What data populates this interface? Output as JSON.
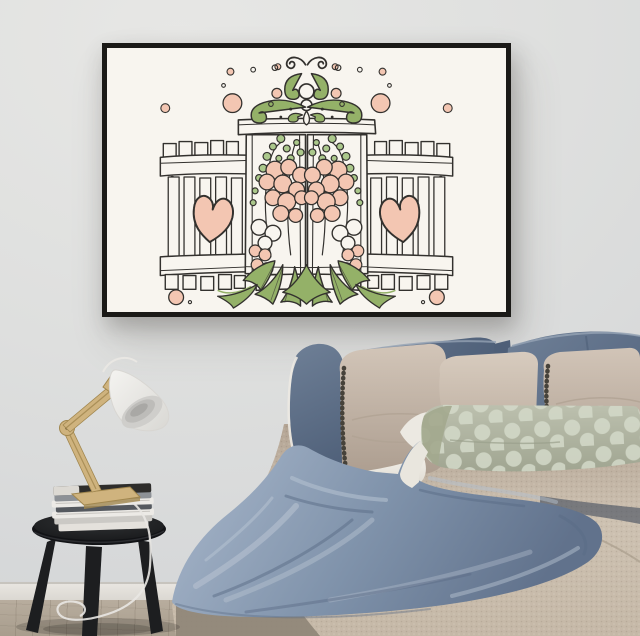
{
  "scene": {
    "setting": "bedroom interior photograph, no text visible",
    "objects": [
      {
        "name": "framed-wall-art",
        "description": "hand-drawn garden-gate illustration: green ornamental scrolls at top, white picket gate and shutters, two pink hearts, pink hollyhock flowers, green leaves, scattered pink dots on cream paper, thin black frame"
      },
      {
        "name": "bed",
        "description": "bed with blue linen pillows with white piping, taupe pillows with dark pompom trim, sage polka-dot lumbar pillow, beige woven bedspread, rumpled blue throw blanket"
      },
      {
        "name": "side-table",
        "description": "round black three-legged stool stacked with magazines"
      },
      {
        "name": "desk-lamp",
        "description": "wooden articulated task lamp with white shade and white cord"
      },
      {
        "name": "floor",
        "description": "light wood floor with white baseboard"
      }
    ],
    "counts": {
      "blue_pillows": 4,
      "beige_pillows": 3,
      "polka_dot_pillows": 1,
      "pink_hearts": 2,
      "magazines": 7
    }
  },
  "colors": {
    "wall-light": "#e7e7e5",
    "wall-mid": "#dedfde",
    "wall-dark": "#d2d4d6",
    "baseboard": "#e8e5e0",
    "floor-top": "#b8ad9e",
    "floor-bottom": "#a89d8d",
    "frame": "#1b1a17",
    "art-bg": "#f8f5ef",
    "art-line": "#33312e",
    "art-pink": "#f3c6b2",
    "art-green": "#94b168",
    "art-green-light": "#abc88b",
    "pillow-blue": "#6d7e95",
    "pillow-blue-dark": "#4e5f78",
    "pillow-blue-light": "#93a1b3",
    "pillow-beige": "#c7b9ac",
    "pillow-beige-dark": "#ab9c8e",
    "pillow-trim": "#46423a",
    "pillow-sage": "#b3b7a4",
    "pillow-dot": "#d4dac9",
    "sheet-white": "#ece9e2",
    "bedspread-top": "#b3a494",
    "bedspread-mid": "#cdc1b1",
    "bedspread-low": "#c5b8a7",
    "bed-side": "#8e8577",
    "blanket": "#8093ab",
    "blanket-light": "#b3bfce",
    "blanket-dark": "#5a6b85",
    "stool": "#1d1e20",
    "magazine-white": "#eceae6",
    "magazine-dark": "#2e2d2b",
    "lamp-wood": "#cfb37e",
    "lamp-wood-dark": "#a1874f",
    "lamp-shade": "#f3f2ef",
    "cable": "#e9e7e3"
  }
}
